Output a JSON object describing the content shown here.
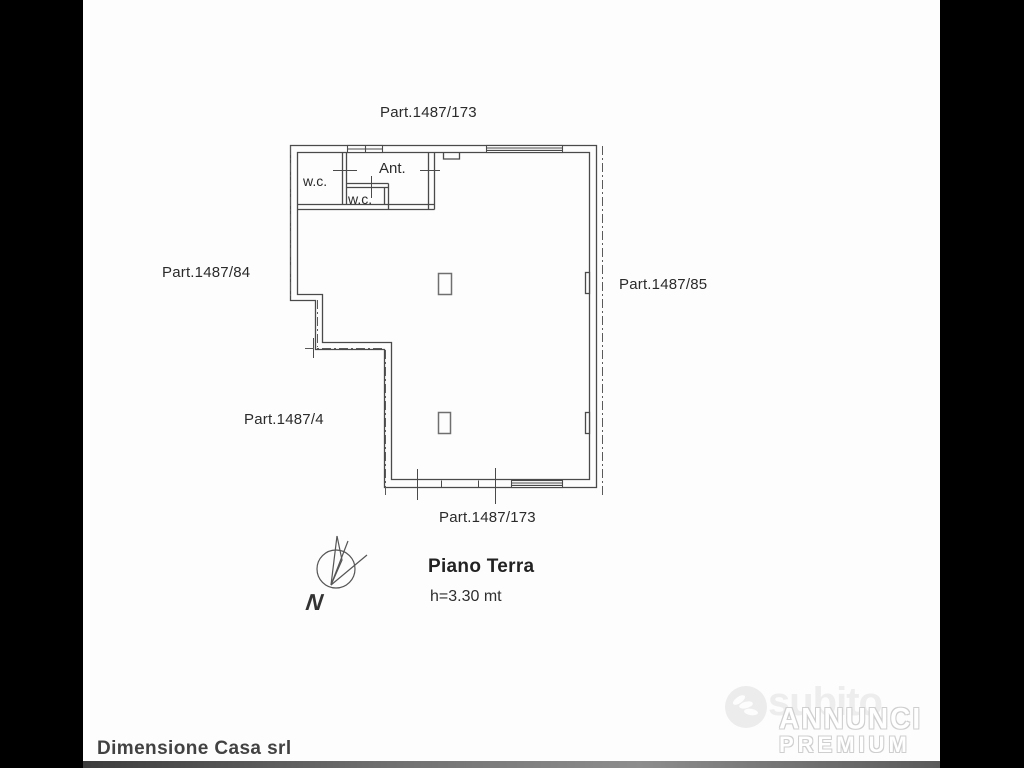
{
  "page": {
    "background": "#000000",
    "paper": "#fdfdfd"
  },
  "plan": {
    "labels": {
      "parcel_top": "Part.1487/173",
      "parcel_left": "Part.1487/84",
      "parcel_right": "Part.1487/85",
      "parcel_bottom_left": "Part.1487/4",
      "parcel_bottom": "Part.1487/173",
      "room_wc_left": "w.c.",
      "room_ant": "Ant.",
      "room_wc_inner": "w.c.",
      "title": "Piano Terra",
      "height_note": "h=3.30 mt",
      "compass_letter": "N"
    },
    "colors": {
      "wall": "#4a4a4a",
      "boundary": "#5a5a5a",
      "pillar": "#6f6f6f",
      "text": "#2b2b2b"
    }
  },
  "footer": {
    "agency": "Dimensione Casa srl"
  },
  "watermark": {
    "brand": "subito",
    "badge_line1": "ANNUNCI",
    "badge_line2": "PREMIUM",
    "color": "#ededed",
    "badge_outline": "#cfcfcf"
  }
}
